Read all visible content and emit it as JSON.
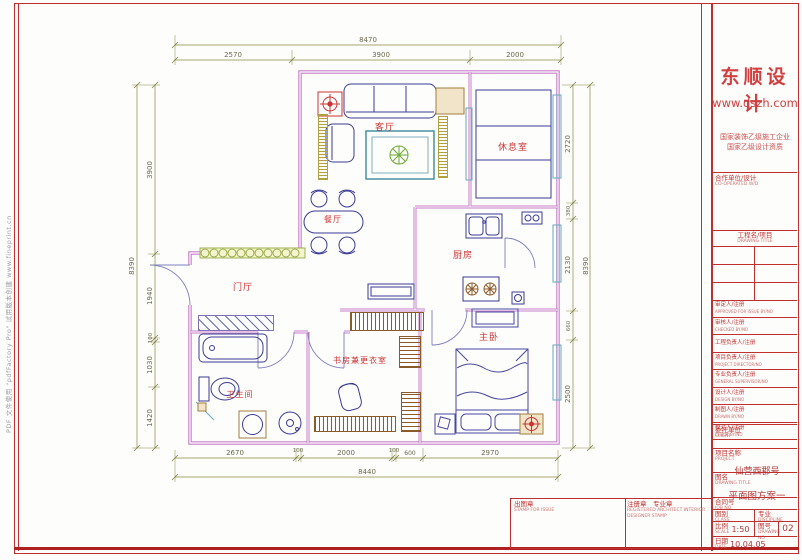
{
  "sheet": {
    "watermark": "PDF 文件使用 \"pdfFactory Pro\" 试用版本创建  www.fineprint.cn"
  },
  "plan": {
    "rooms": [
      "客厅",
      "休息室",
      "餐厅",
      "厨房",
      "门厅",
      "书房兼更衣室",
      "卫生间",
      "主卧"
    ],
    "dims": {
      "top": {
        "overall": "8470",
        "segments": [
          "2570",
          "3900",
          "2000"
        ]
      },
      "bottom": {
        "overall": "8440",
        "segments": [
          "2670",
          "100",
          "2000",
          "100",
          "600",
          "2970"
        ]
      },
      "left": {
        "overall": "8390",
        "segments": [
          "3900",
          "1940",
          "100",
          "1030",
          "1420"
        ]
      },
      "right": {
        "overall": "8390",
        "segments": [
          "2720",
          "380",
          "2130",
          "660",
          "2500"
        ]
      }
    }
  },
  "titleblock": {
    "logo": "东顺设计",
    "website": "www.dszh.com",
    "cert1": "国家装饰乙级施工企业",
    "cert2": "国家乙级设计资质",
    "coop_zh": "合作单位/设计",
    "coop_en": "CO-OPERATED W/D",
    "proj_hdr_zh": "工程名/项目",
    "proj_hdr_en": "DRAWING TITLE",
    "rows": [
      {
        "zh": "审定人/注册",
        "en": "APPROVED FOR ISSUE BY/NO"
      },
      {
        "zh": "审核人/注册",
        "en": "CHECKED BY/NO"
      },
      {
        "zh": "工程负责人/注册",
        "en": ""
      },
      {
        "zh": "项目负责人/注册",
        "en": "PROJECT DIRECTOR/NO"
      },
      {
        "zh": "专业负责人/注册",
        "en": "GENERAL SUPERVISOR/NO"
      },
      {
        "zh": "设计人/注册",
        "en": "DESIGN BY/NO"
      },
      {
        "zh": "制图人/注册",
        "en": "DRAWN BY/NO"
      },
      {
        "zh": "校对人/注册",
        "en": "CHECK BY/NO"
      }
    ],
    "client_zh": "委托单位",
    "client_en": "CLIENT",
    "project_zh": "项目名称",
    "project_en": "PROJECT",
    "project_value": "仙营西郡号",
    "title_zh": "图名",
    "title_en": "DRAWING TITLE",
    "title_value": "平面图方案一",
    "job_zh": "合同号",
    "job_en": "JOB NO.",
    "class_zh": "图别",
    "class_en": "CLASS",
    "disc_zh": "专业",
    "disc_en": "DISCIPLINE",
    "scale_zh": "比例",
    "scale_en": "SCALE",
    "scale_value": "1:50",
    "dwg_zh": "图号",
    "dwg_en": "DRAWING NO",
    "dwg_value": "02",
    "date_zh": "日期",
    "date_en": "DATE",
    "date_value": "10.04.05"
  },
  "stamps": {
    "issue_zh": "出图章",
    "issue_en": "STAMP FOR ISSUE",
    "reg_zh": "注册章　专业章",
    "reg_en": "REGISTERED ARCHITECT INTERIOR DESIGNER STAMP"
  },
  "colors": {
    "wall": "#c87fc8",
    "furniture": "#3c3c96",
    "window": "#6aa8c0",
    "dim": "#8a8a45",
    "room_label": "#cc3333",
    "frame": "#c03030",
    "hatch": "#8a5a28",
    "plant": "#6aa832"
  }
}
